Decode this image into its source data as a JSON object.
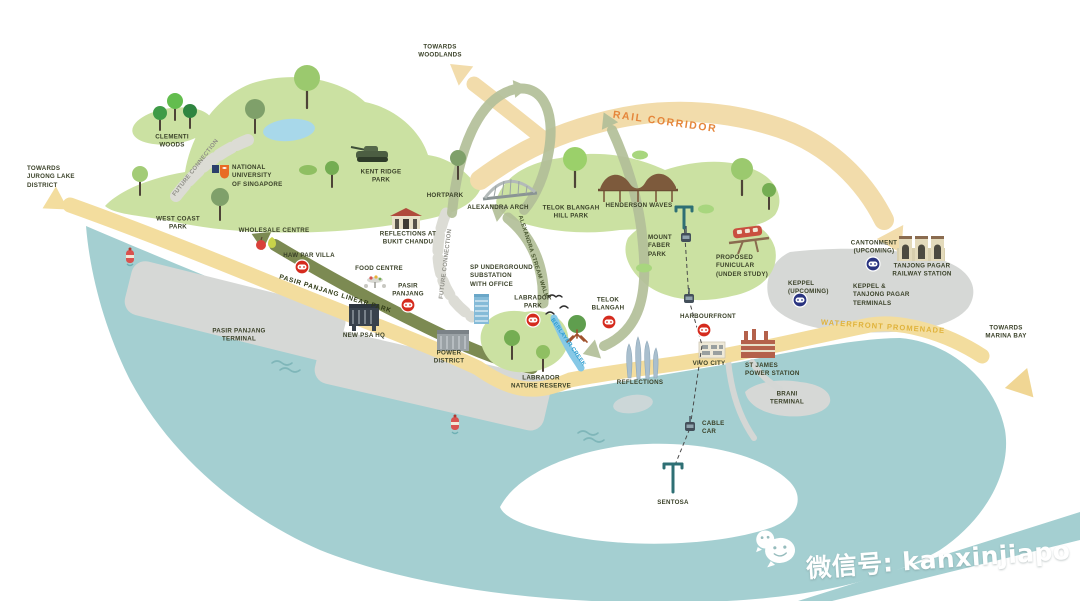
{
  "title": "Greater Southern Waterfront illustrated map",
  "colors": {
    "water": "#a4cfd1",
    "land": "#cbe1a2",
    "sand": "#f3dd9e",
    "rail_corridor_band": "#f2dcab",
    "rail_corridor_text": "#e5863b",
    "promenade_text": "#e0b33c",
    "linear_park_band": "#7c8a52",
    "loop_arrow": "#b3bf99",
    "terminal_gray": "#d6d8d6",
    "mrt_red": "#d52b1e",
    "mrt_navy": "#2a3480",
    "creek": "#86c8e6",
    "creek_text": "#2f9fd0"
  },
  "labels": {
    "towards_jurong": {
      "text": "TOWARDS\nJURONG LAKE\nDISTRICT"
    },
    "clementi_woods": {
      "text": "CLEMENTI\nWOODS"
    },
    "future_connection_1": {
      "text": "FUTURE CONNECTION"
    },
    "nus": {
      "text": "NATIONAL\nUNIVERSITY\nOF SINGAPORE"
    },
    "west_coast_park": {
      "text": "WEST COAST\nPARK"
    },
    "wholesale_centre": {
      "text": "WHOLESALE CENTRE"
    },
    "haw_par_villa": {
      "text": "HAW PAR VILLA"
    },
    "food_centre": {
      "text": "FOOD CENTRE"
    },
    "pasir_panjang": {
      "text": "PASIR\nPANJANG"
    },
    "pasir_panjang_linear_park": {
      "text": "PASIR PANJANG LINEAR PARK"
    },
    "pasir_panjang_terminal": {
      "text": "PASIR PANJANG\nTERMINAL"
    },
    "new_psa_hq": {
      "text": "NEW PSA HQ"
    },
    "power_district": {
      "text": "POWER\nDISTRICT"
    },
    "towards_woodlands": {
      "text": "TOWARDS\nWOODLANDS"
    },
    "kent_ridge_park": {
      "text": "KENT RIDGE\nPARK"
    },
    "hortpark": {
      "text": "HORTPARK"
    },
    "alexandra_arch": {
      "text": "ALEXANDRA ARCH"
    },
    "reflections_bukit_chandu": {
      "text": "REFLECTIONS AT\nBUKIT CHANDU"
    },
    "future_connection_2": {
      "text": "FUTURE CONNECTION"
    },
    "alexandra_stream_walk": {
      "text": "ALEXANDRA STREAM WALK"
    },
    "sp_substation": {
      "text": "SP UNDERGROUND\nSUBSTATION\nWITH OFFICE"
    },
    "telok_blangah_hill_park": {
      "text": "TELOK BLANGAH\nHILL PARK"
    },
    "henderson_waves": {
      "text": "HENDERSON WAVES"
    },
    "mount_faber_park": {
      "text": "MOUNT\nFABER\nPARK"
    },
    "proposed_funicular": {
      "text": "PROPOSED\nFUNICULAR\n(UNDER STUDY)"
    },
    "rail_corridor": {
      "text": "RAIL CORRIDOR"
    },
    "labrador_park": {
      "text": "LABRADOR\nPARK"
    },
    "telok_blangah": {
      "text": "TELOK\nBLANGAH"
    },
    "berlayer_creek": {
      "text": "BERLAYER CREEK"
    },
    "labrador_nature_reserve": {
      "text": "LABRADOR\nNATURE RESERVE"
    },
    "harbourfront": {
      "text": "HARBOURFRONT"
    },
    "vivo_city": {
      "text": "VIVO CITY"
    },
    "st_james": {
      "text": "ST JAMES\nPOWER STATION"
    },
    "reflections": {
      "text": "REFLECTIONS"
    },
    "brani_terminal": {
      "text": "BRANI\nTERMINAL"
    },
    "cable_car": {
      "text": "CABLE\nCAR"
    },
    "sentosa": {
      "text": "SENTOSA"
    },
    "cantonment": {
      "text": "CANTONMENT\n(UPCOMING)"
    },
    "tanjong_pagar_station": {
      "text": "TANJONG PAGAR\nRAILWAY STATION"
    },
    "keppel_upcoming": {
      "text": "KEPPEL\n(UPCOMING)"
    },
    "keppel_terminals": {
      "text": "KEPPEL &\nTANJONG PAGAR\nTERMINALS"
    },
    "waterfront_promenade": {
      "text": "WATERFRONT PROMENADE"
    },
    "towards_marina_bay": {
      "text": "TOWARDS\nMARINA BAY"
    }
  },
  "watermark": {
    "text": "微信号: kanxinjiapo",
    "icon": "wechat-icon"
  }
}
